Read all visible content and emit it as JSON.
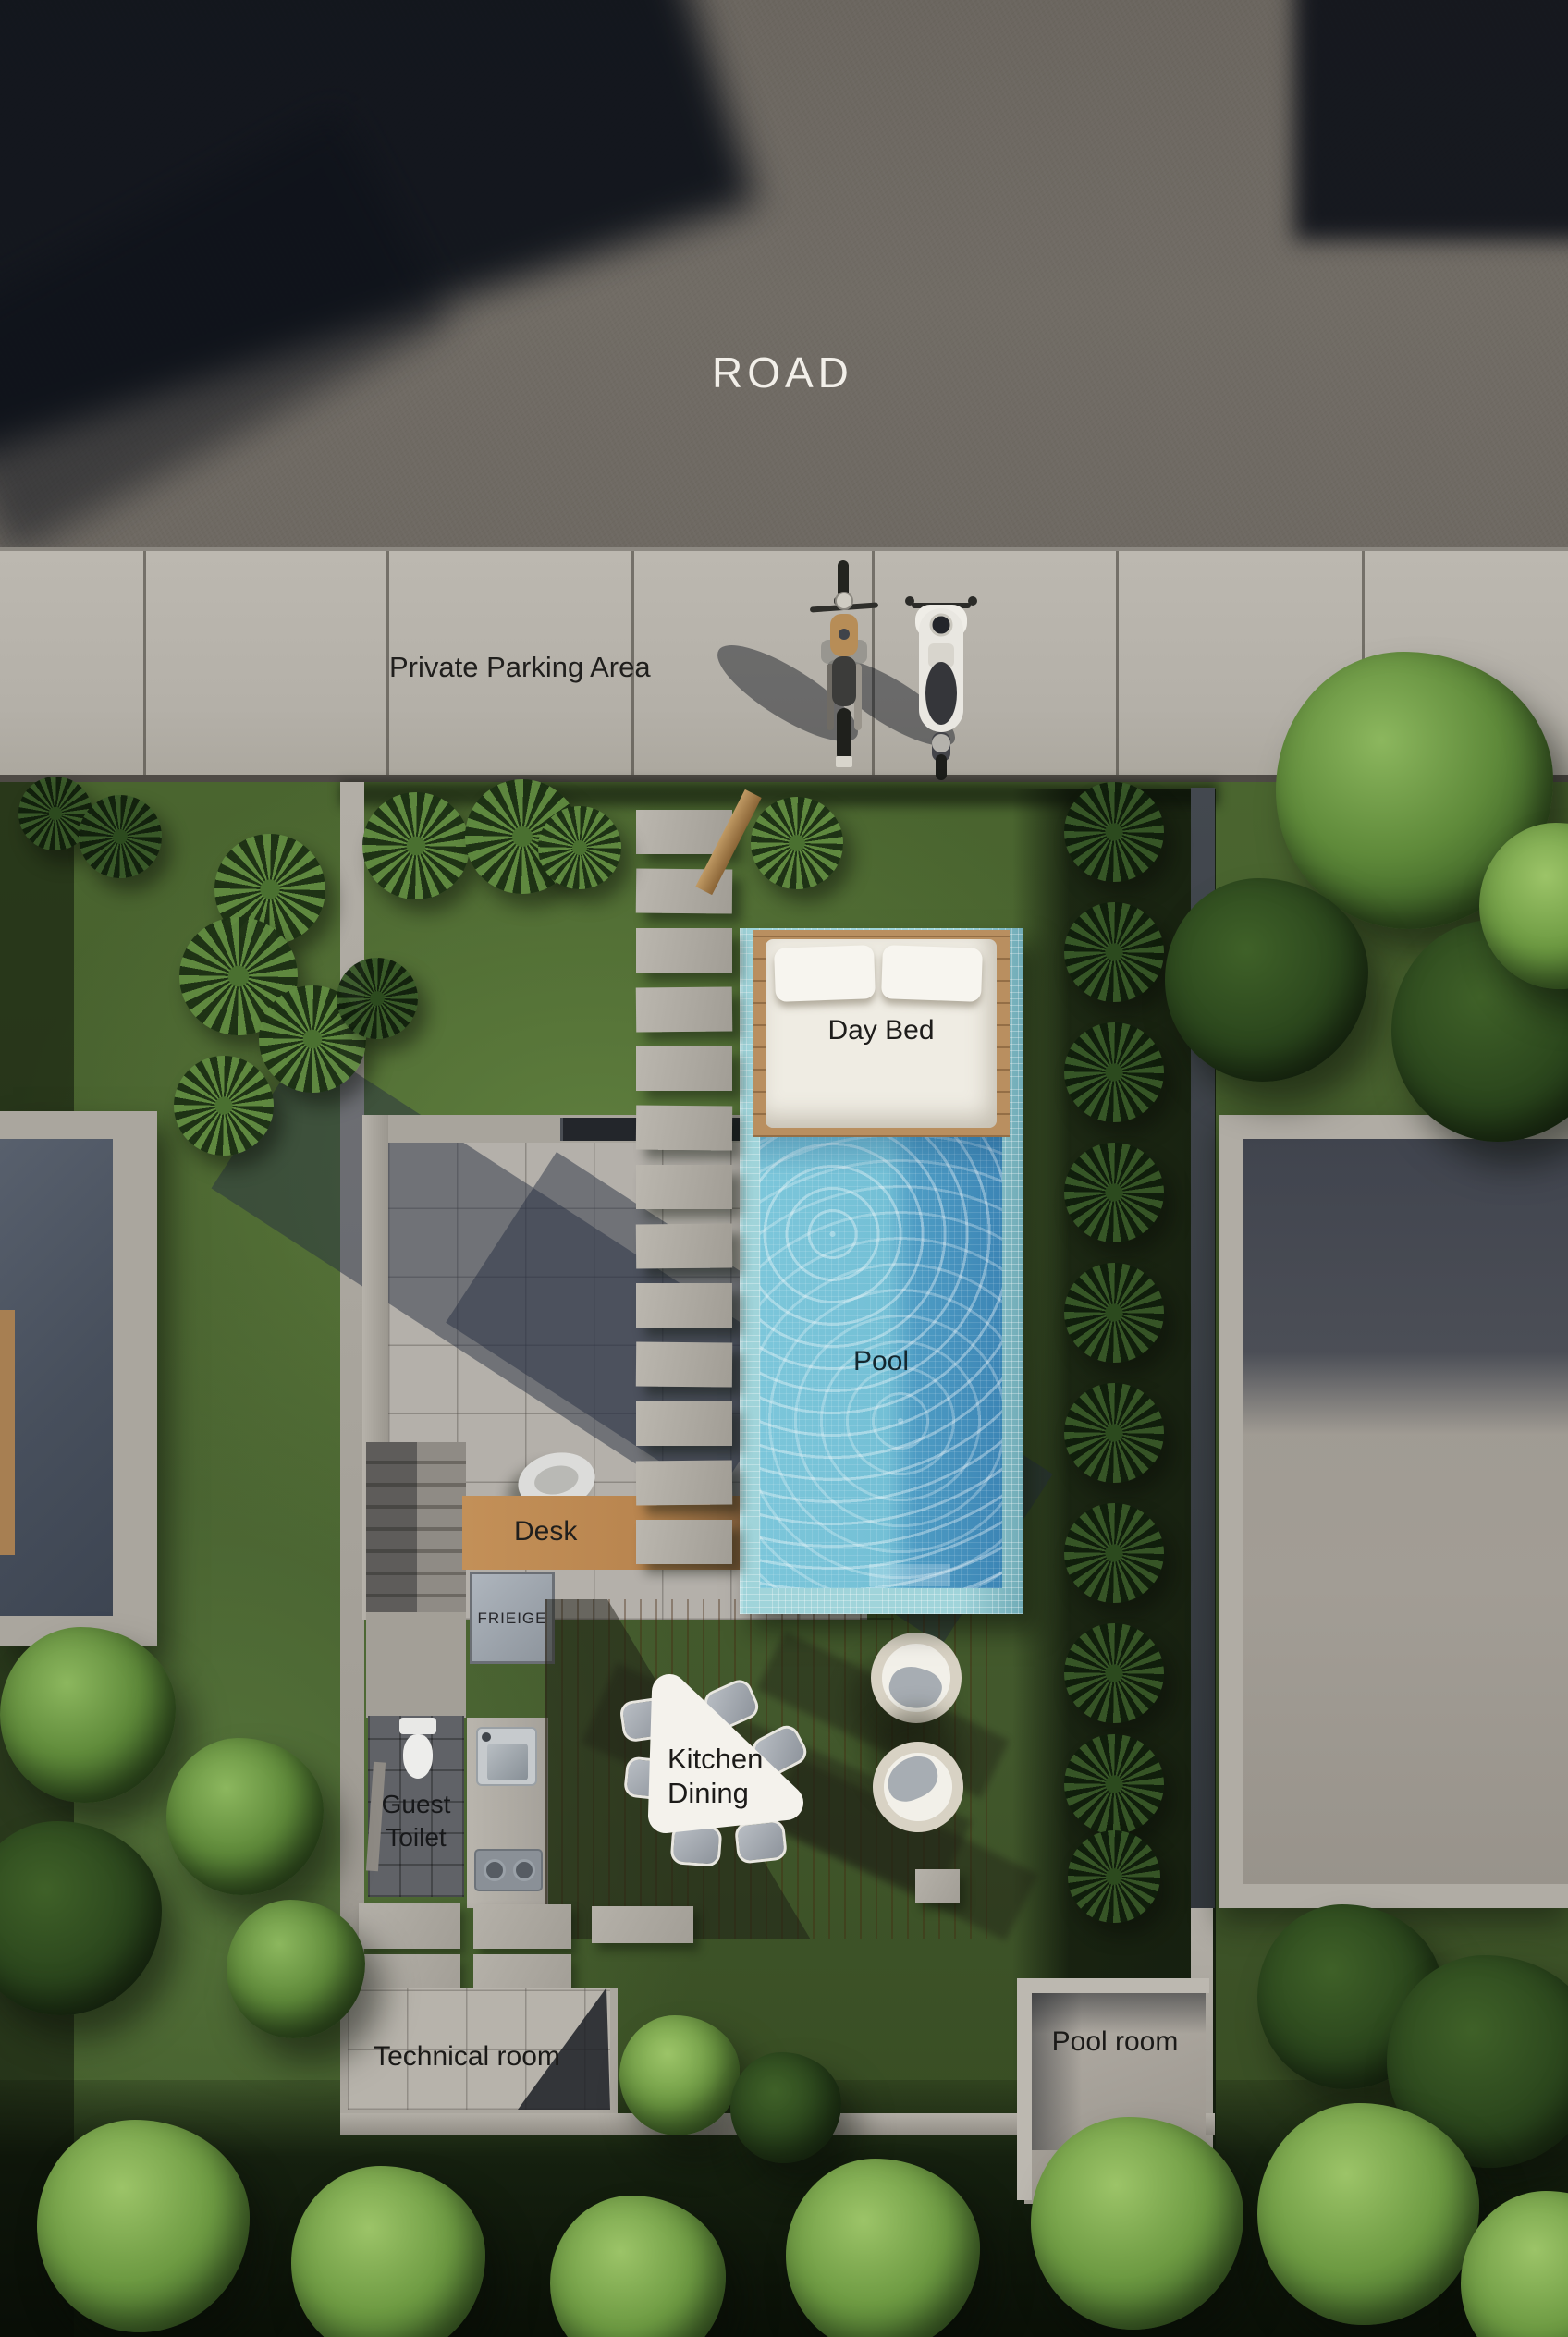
{
  "title": "Villa site plan aerial render",
  "labels": {
    "road": "ROAD",
    "parking": "Private Parking Area",
    "day_bed": "Day Bed",
    "pool": "Pool",
    "desk": "Desk",
    "fridge": "FRIEIGE",
    "kitchen_dining_line1": "Kitchen",
    "kitchen_dining_line2": "Dining",
    "guest_toilet_line1": "Guest",
    "guest_toilet_line2": "Toilet",
    "technical_room": "Technical room",
    "pool_room": "Pool room"
  },
  "colors": {
    "road": "#6f6a63",
    "concrete": "#b6b2aa",
    "grass": "#46602e",
    "pool_water": "#74c0d6",
    "pool_tile": "#a0d4da",
    "deck_wood": "#b5854e",
    "label_dark": "#1b1a18",
    "label_light": "#f2efe9"
  }
}
